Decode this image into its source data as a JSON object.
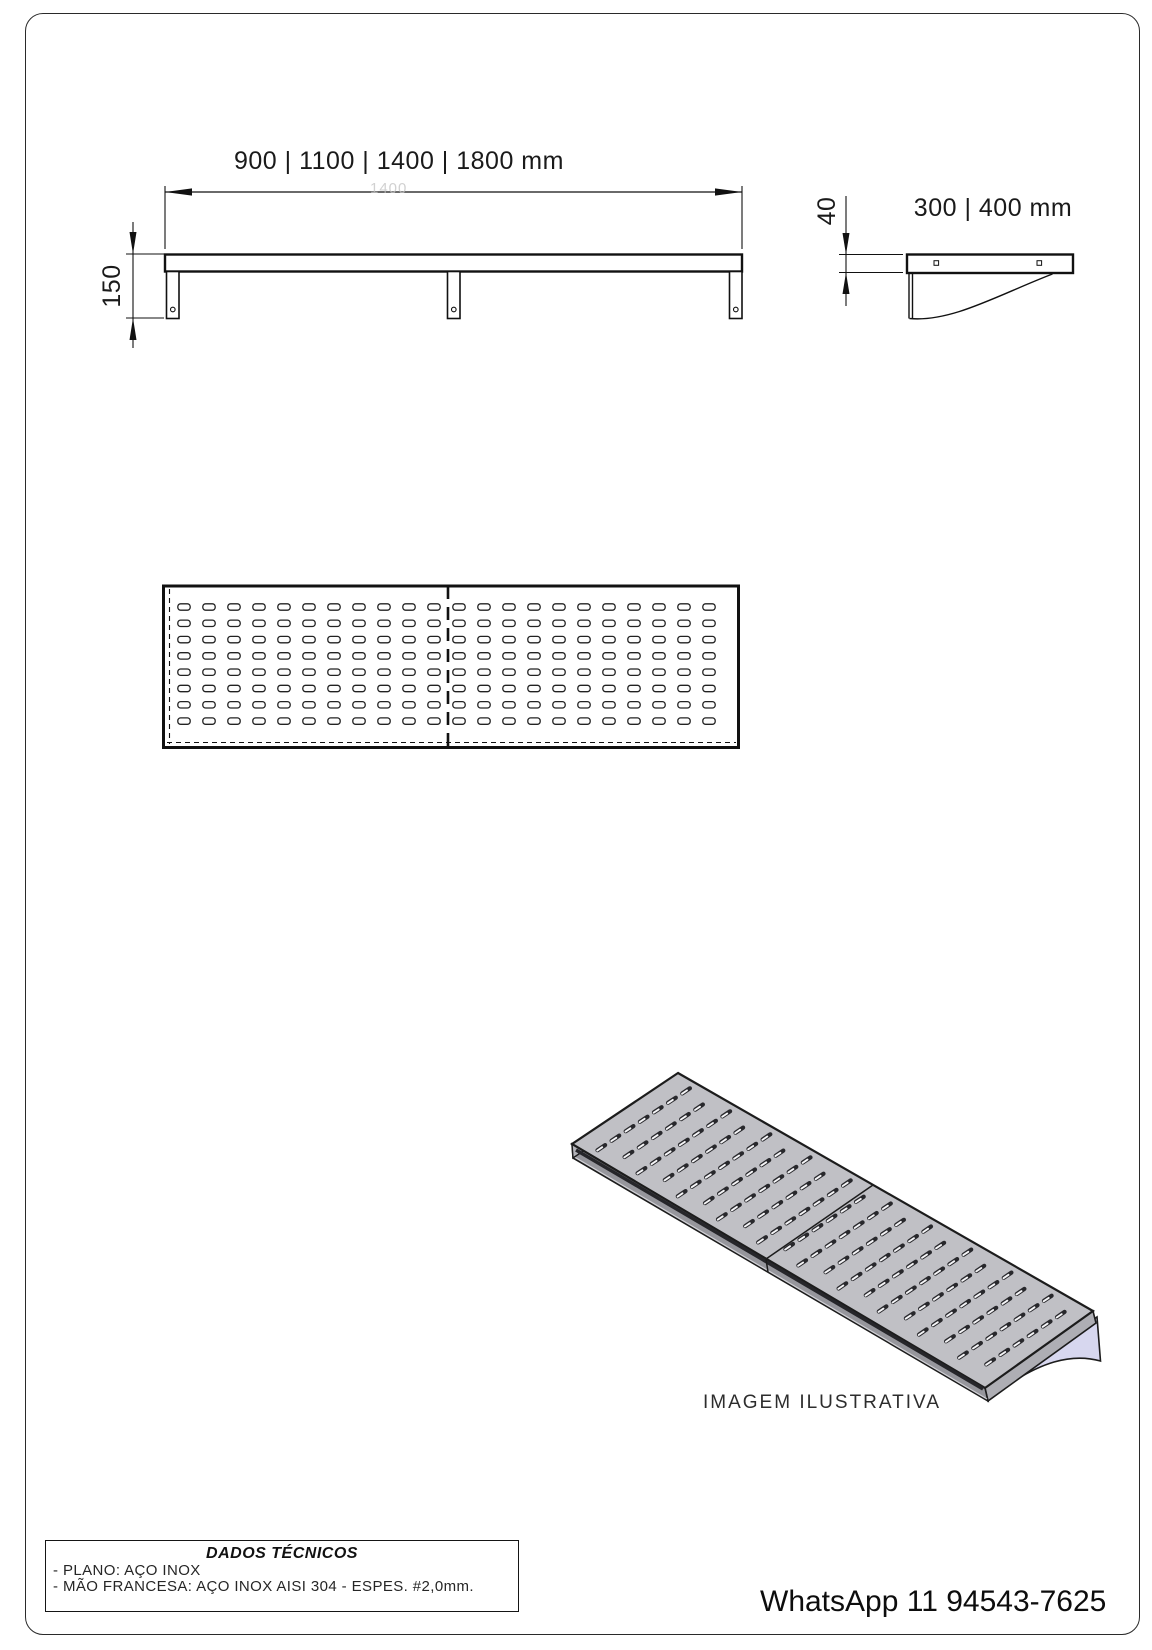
{
  "views": {
    "front": {
      "width_label": "900 | 1100 | 1400 | 1800 mm",
      "height_label": "150",
      "ghost_label": "1400"
    },
    "side": {
      "depth_label": "300 | 400 mm",
      "thickness_label": "40"
    },
    "plan": {
      "slot_rows": 8,
      "slot_cols": 22
    },
    "iso": {
      "caption": "IMAGEM ILUSTRATIVA",
      "slot_rows": 7,
      "slot_cols": 20,
      "steel_color": "#c0c0c5",
      "steel_front_color": "#96969c",
      "steel_end_color": "#aeaeb4",
      "bracket_color": "#d7d7ef"
    }
  },
  "tech_box": {
    "title": "DADOS TÉCNICOS",
    "lines": [
      "- PLANO: AÇO INOX",
      "- MÃO FRANCESA: AÇO INOX AISI 304 - ESPES. #2,0mm."
    ]
  },
  "footer": {
    "whatsapp": "WhatsApp 11 94543-7625"
  }
}
